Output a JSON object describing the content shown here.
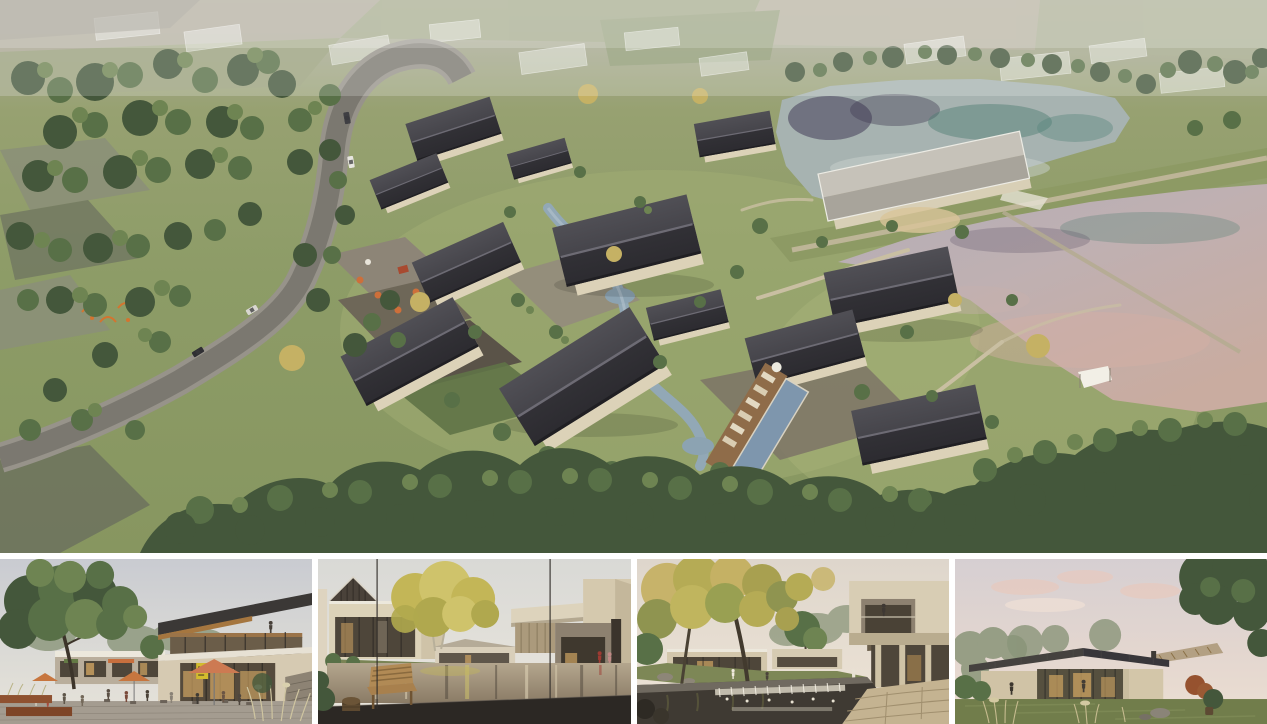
{
  "board": {
    "type": "architectural rendering presentation board",
    "subject": "lakeside courtyard village resort",
    "layout": "one large aerial rendering above a strip of four eye-level renderings separated by white gutters",
    "text_on_image": "none — no legible text anywhere; the small cafe menu sign in the first panel is illegible"
  },
  "palette": {
    "white": "#ffffff",
    "grassBase": "#8b9a65",
    "meadowLight": "#a9b37b",
    "treeDark": "#44573b",
    "treeMid": "#587047",
    "treeLight": "#6e8452",
    "treeFaint": "#8a9579",
    "treeGold": "#c5b164",
    "roadOuter": "#97938a",
    "roadInner": "#7b7870",
    "fieldGrey": "#899076",
    "roofDark": "#3a393c",
    "roofPale": "#b7b3aa",
    "wallCream": "#dcd2b8",
    "stoneDark": "#665f52",
    "stoneMid": "#948c7c",
    "streamBlue": "#92a8b6",
    "poolBlue": "#7e96ad",
    "deckWood": "#8f6c49",
    "lakeUpper": "#a7b3b1",
    "lakePink": "#c6aba1",
    "reflTeal": "#4e7d70",
    "reflIndigo": "#443d57",
    "bermGrass": "#8d9a64",
    "pathBeige": "#c9bfa2",
    "skyCool": "#cfd1d5",
    "skyWarm": "#e9e0d2",
    "skyPink": "#e4c6bc",
    "umbrellaSalmon": "#cd7a52",
    "umbrellaOrange": "#c7763f",
    "corten": "#92522f",
    "glassDark": "#4e463a",
    "glowWarm": "#cfa463",
    "benchWood": "#a8804d",
    "deckDark": "#2c2824",
    "lawnPanel": "#76814f",
    "canopyYellow": "#c3b657",
    "soffitWood": "#a5763f",
    "signYellow": "#d3bc2e",
    "fasciaWhite": "#ece8dc",
    "paving": "#a49c90"
  },
  "aerial": {
    "label": "aerial-masterplan-rendering",
    "description": "Bird's-eye view of a courtyard village of cream-walled houses with dark pitched roofs set in meadows. A winding stream and a lap pool with timber sun deck thread between the buildings; outdoor dining with orange parasols and a playground sit on stone terraces; a curving grey access road with cars runs down the left through dense tree belts over hazy field strips; two large ponds divided by a grass dam with a footpath and a thin causeway lie to the right; translucent future-phase building outlines stand along the hazy horizon.",
    "features": [
      "curving access road with four cars",
      "cluster of gabled courtyard houses",
      "winding blue stream with small ponds",
      "lap pool with loungers and parasol",
      "dining terrace with orange umbrellas",
      "orange playground nets",
      "upper pond with indigo and teal tree reflections",
      "lower pink-tinted pond with grass dam, footpath and causeway",
      "white shade sail and golden trees at the shore",
      "dense tree belts along the bottom edge",
      "ghosted white massing of future phases at the horizon"
    ]
  },
  "panels": [
    {
      "label": "panel-cafe-plaza",
      "description": "Eye-level view of the cafe plaza: a two-storey clubhouse with a deep mono-pitch roof and timber soffit, glowing shopfront with a small yellow menu sign, salmon and orange parasols over outdoor tables with seated visitors, a mature tree and corten planters on the left, ornamental grasses by a stone wall on the right."
    },
    {
      "label": "panel-pond-courtyard",
      "description": "Courtyard reflecting pond seen from a dark timber deck with a wooden bench and drum stool in the foreground; cream two-storey villas with glass walls and a slatted gable on the left, a golden tree leaning over the water, cantilevered cream volumes with two figures in red and pink on the right; thin window mullions cross the view."
    },
    {
      "label": "panel-stream-courtyard",
      "description": "Garden courtyard with a stone weir stepping the dark stream in the foreground, a large autumn tree on the left, a lawn with boulders and low glass pavilions beyond, and a cream cantilevered balcony with a standing figure above a shaded colonnade on the right; a stone path enters from the lower right."
    },
    {
      "label": "panel-lake-pavilion",
      "description": "Dusk view of a single-storey glass pavilion with a low dark standing-seam roof, warm lit interior and a timber-soffit wing, framed by soft trees on the left and a large dark tree overhanging from the right; ornamental grasses, boulders, a russet shrub and a lone visitor in the lawn foreground under a pink-tinged sky."
    }
  ]
}
